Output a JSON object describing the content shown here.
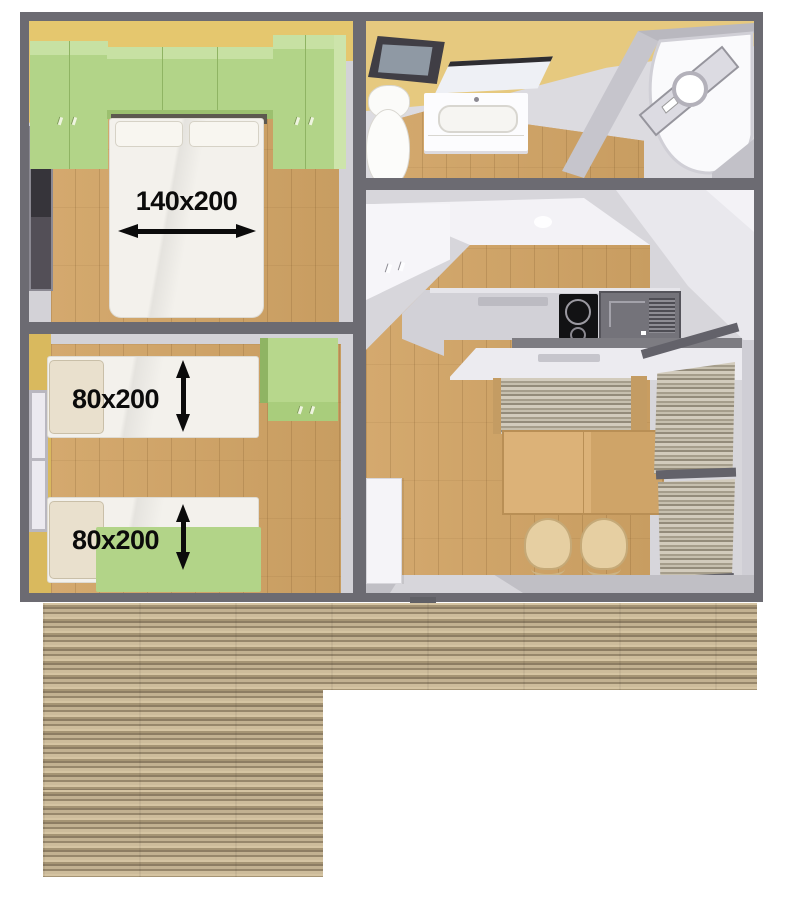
{
  "floorplan": {
    "dimension_annotations": [
      {
        "room": "double-bedroom",
        "label": "140x200",
        "arrow_orientation": "horizontal"
      },
      {
        "room": "twin-bedroom-bed-1",
        "label": "80x200",
        "arrow_orientation": "vertical"
      },
      {
        "room": "twin-bedroom-bed-2",
        "label": "80x200",
        "arrow_orientation": "vertical"
      }
    ],
    "colors": {
      "wall": "#6c6b72",
      "accent_green": "#b2d488",
      "accent_yellow": "#e5c76e",
      "floor_wood": "#cfa368",
      "deck_wood": "#b1a081",
      "label_ink": "#0b0b0b"
    }
  }
}
